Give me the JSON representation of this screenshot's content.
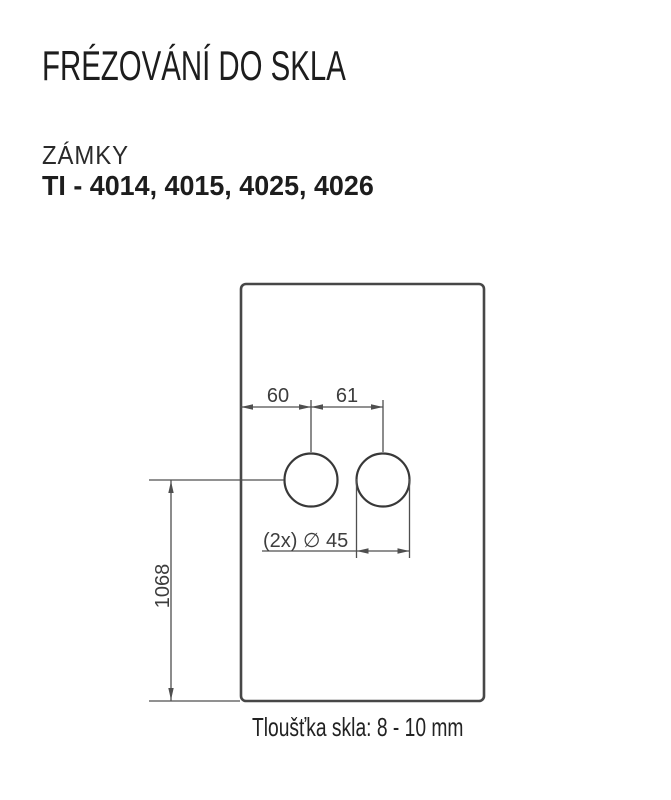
{
  "header": {
    "title": "FRÉZOVÁNÍ DO SKLA",
    "category": "ZÁMKY",
    "models": "TI - 4014, 4015, 4025, 4026"
  },
  "drawing": {
    "labels": {
      "offset_from_edge": "60",
      "hole_spacing": "61",
      "hole_diameter": "(2x) ∅ 45",
      "height_from_bottom": "1068"
    },
    "note": "Tloušťka skla: 8 - 10 mm"
  },
  "colors": {
    "background": "#ffffff",
    "heading_text": "#1d1d1d",
    "drawing_line": "#4f4f4f",
    "drawing_text": "#3d3d3d"
  }
}
